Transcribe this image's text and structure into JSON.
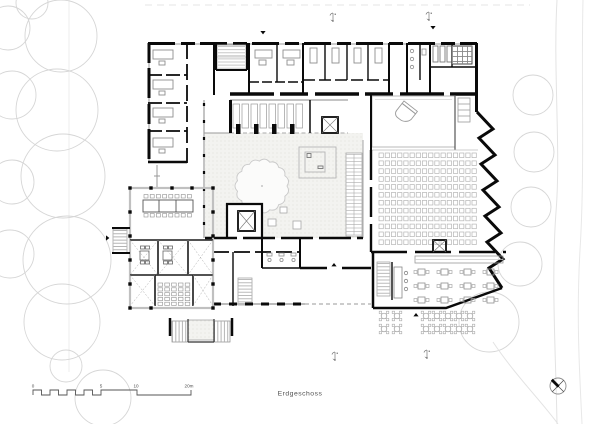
{
  "labels": {
    "drawing_title": "Erdgeschoss"
  },
  "scale_bar": {
    "unit": "m",
    "ticks": [
      {
        "label": "0",
        "x": 33
      },
      {
        "label": "5",
        "x": 101
      },
      {
        "label": "10",
        "x": 136
      },
      {
        "label": "20m",
        "x": 189
      }
    ]
  },
  "colors": {
    "wall": "#0a0a0a",
    "detail_gray": "#9a9a9a",
    "furniture_gray": "#8f8f8f",
    "tree_outline": "#d6d6d6",
    "courtyard_fill": "#f3f3f0",
    "annotation_text": "#4f4f4f"
  },
  "site": {
    "trees_left": [
      [
        32,
        3,
        16
      ],
      [
        8,
        28,
        22
      ],
      [
        61,
        36,
        36
      ],
      [
        12,
        95,
        24
      ],
      [
        57,
        110,
        41
      ],
      [
        12,
        182,
        22
      ],
      [
        63,
        176,
        42
      ],
      [
        10,
        254,
        24
      ],
      [
        67,
        260,
        44
      ],
      [
        62,
        322,
        38
      ],
      [
        66,
        366,
        16
      ],
      [
        103,
        398,
        28
      ]
    ],
    "trees_right": [
      [
        533,
        95,
        20
      ],
      [
        534,
        152,
        20
      ],
      [
        531,
        207,
        20
      ],
      [
        520,
        264,
        22
      ],
      [
        489,
        322,
        30
      ]
    ]
  },
  "courtyard": {
    "tree": {
      "cx": 262,
      "cy": 186,
      "r": 25,
      "bumps": 15
    }
  },
  "auditorium": {
    "seat_rows": 12,
    "seats_per_row": 16,
    "x": 379,
    "y": 153,
    "dx": 6.2,
    "dy": 7.9,
    "w": 4.3,
    "h": 4.6
  },
  "cafe": {
    "tables": {
      "cols": 4,
      "rows": 3,
      "x": 418,
      "y": 269,
      "dx": 23,
      "dy": 14,
      "w": 7,
      "h": 6
    }
  },
  "terrace": {
    "table_r": 2.8,
    "groups": [
      {
        "x": 384,
        "y": 316,
        "cols": 2,
        "rows": 2,
        "dx": 13,
        "dy": 13
      },
      {
        "x": 426,
        "y": 316,
        "cols": 5,
        "rows": 2,
        "dx": 11,
        "dy": 13
      }
    ]
  },
  "villa": {
    "conference_chairs": {
      "top": 8,
      "bottom": 8,
      "x": 144,
      "y": 194.5,
      "dx": 6.2,
      "row_gap": 19
    },
    "audience": {
      "x": 158,
      "y": 283,
      "cols": 5,
      "rows": 5,
      "dx": 6.8,
      "dy": 4.8,
      "w": 4.6,
      "h": 3.2
    }
  },
  "booths": {
    "x": 233,
    "y": 104,
    "count": 4,
    "dx": 18
  },
  "markers": {
    "entrances": [
      {
        "dir": "down",
        "x": 263,
        "y": 31
      },
      {
        "dir": "down",
        "x": 433,
        "y": 26
      },
      {
        "dir": "right",
        "x": 106,
        "y": 238
      },
      {
        "dir": "up",
        "x": 334,
        "y": 263
      },
      {
        "dir": "up",
        "x": 416,
        "y": 313
      }
    ],
    "sections": [
      {
        "x": 331,
        "y": 13
      },
      {
        "x": 427,
        "y": 12
      },
      {
        "x": 333,
        "y": 352
      },
      {
        "x": 425,
        "y": 350
      }
    ]
  },
  "north_arrow": {
    "cx": 558,
    "cy": 386,
    "r": 8
  }
}
